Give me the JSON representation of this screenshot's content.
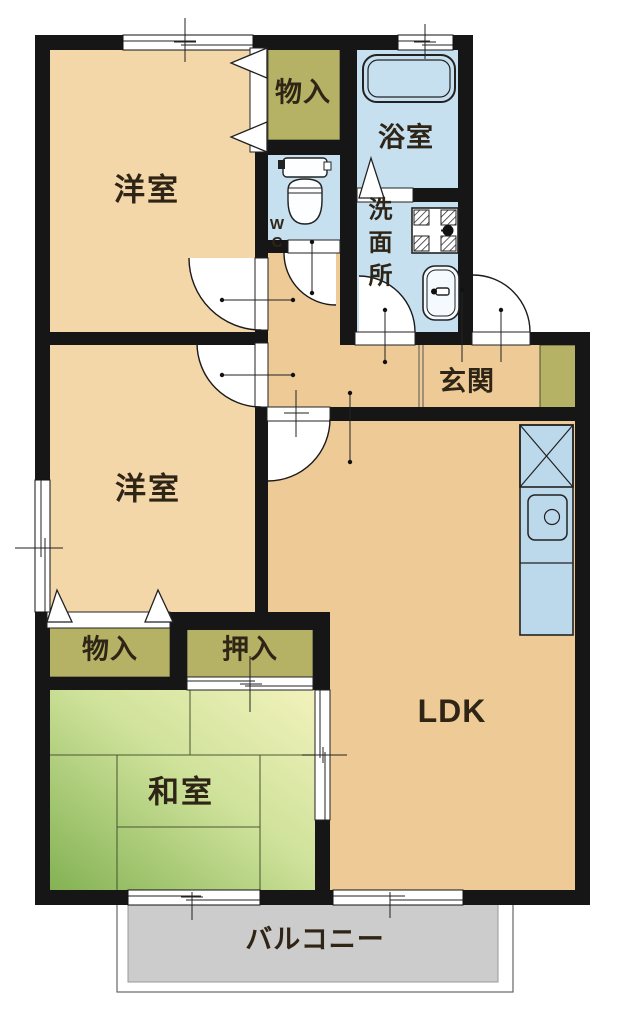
{
  "title": "2LDK apartment floor plan",
  "rooms": {
    "yoshitsu_top": "洋室",
    "yoshitsu_mid": "洋室",
    "washitsu": "和室",
    "ldk": "LDK",
    "genkan": "玄関",
    "yokushitsu": "浴室",
    "senmenjo": "洗面所",
    "wc": "WC",
    "monoiri_top": "物入",
    "monoiri_bottom": "物入",
    "oshiire": "押入",
    "balcony": "バルコニー"
  },
  "icons": [
    "bathtub-icon",
    "toilet-icon",
    "washing-machine-icon",
    "washbasin-icon",
    "refrigerator-space-icon",
    "kitchen-sink-icon"
  ],
  "colors": {
    "wall": "#161616",
    "floor": "#edca96",
    "room": "#f4d7a9",
    "wet": "#c6e0f0",
    "kitchen": "#bcd9ec",
    "closet": "#b5b165",
    "tatami_dark": "#83b254",
    "tatami_mid": "#cfe29a",
    "tatami_light": "#f2f2bc",
    "balcony_fill": "#cccccc",
    "text": "#2f2517"
  }
}
